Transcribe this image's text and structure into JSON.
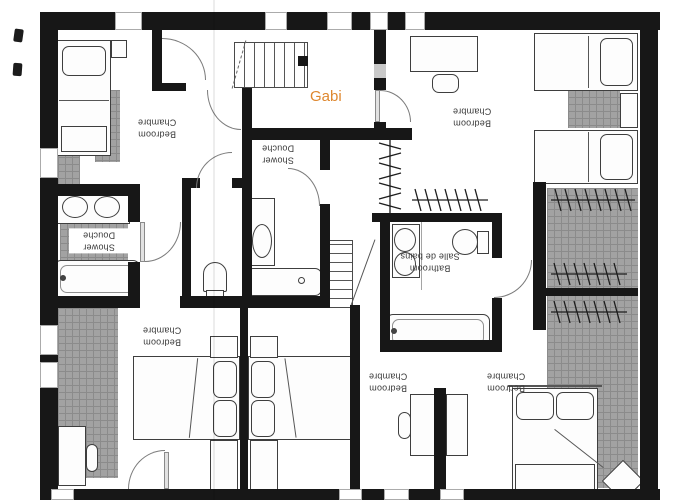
{
  "annotation": {
    "name": "Gabi"
  },
  "rooms": {
    "bedroom_top_left": {
      "en": "Bedroom",
      "fr": "Chambre"
    },
    "shower_middle": {
      "en": "Shower",
      "fr": "Douche"
    },
    "bedroom_top_right": {
      "en": "Bedroom",
      "fr": "Chambre"
    },
    "shower_left": {
      "en": "Shower",
      "fr": "Douche"
    },
    "bathroom": {
      "en": "Bathroom",
      "fr": "Salle de bains"
    },
    "bedroom_bottom_left": {
      "en": "Bedroom",
      "fr": "Chambre"
    },
    "bedroom_bottom_mid": {
      "en": "Bedroom",
      "fr": "Chambre"
    },
    "bedroom_bottom_right": {
      "en": "Bedroom",
      "fr": "Chambre"
    }
  },
  "colors": {
    "wall": "#171717",
    "tile": "#a2a2a2",
    "tile_line": "#8b8b8b",
    "label": "#3a3a3a",
    "annotation": "#de872e"
  }
}
